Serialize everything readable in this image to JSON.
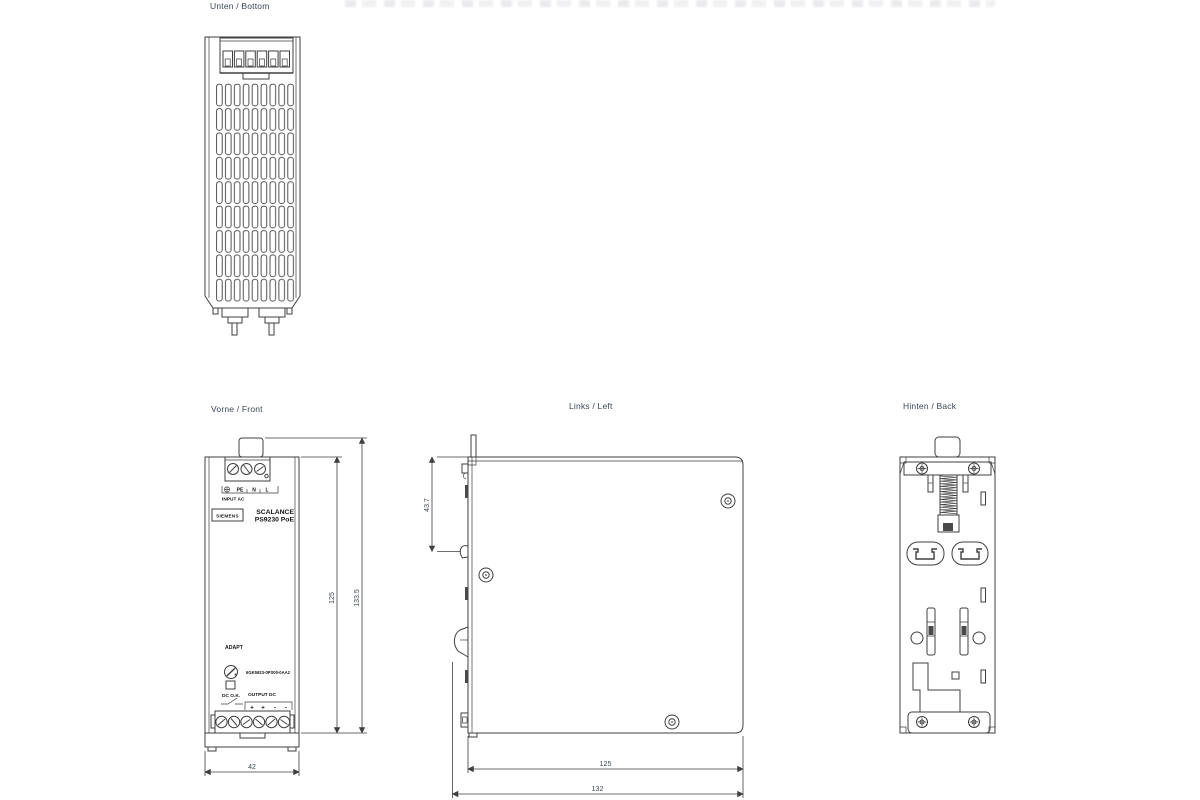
{
  "colors": {
    "line": "#3f3f3f",
    "dim": "#3b4559",
    "device-text": "#141414",
    "bg": "#ffffff"
  },
  "views": {
    "bottom": {
      "label": "Unten / Bottom"
    },
    "front": {
      "label": "Vorne / Front",
      "brand": "SIEMENS",
      "product_line1": "SCALANCE",
      "product_line2": "PS9230 PoE",
      "input_terminals": [
        "PE",
        "N",
        "L"
      ],
      "input_caption": "INPUT AC",
      "adjust_label": "ADAPT",
      "article_number": "6GK5923-0PS00-0AA2",
      "dc_ok_label": "DC O.K.",
      "output_caption": "OUTPUT DC",
      "output_terminals": [
        "+",
        "+",
        "-",
        "-"
      ],
      "dims": {
        "width": "42",
        "body_height": "125",
        "total_height": "133.5"
      }
    },
    "left": {
      "label": "Links / Left",
      "dims": {
        "rail_offset": "43.7",
        "depth": "125",
        "total_depth": "132"
      }
    },
    "back": {
      "label": "Hinten / Back"
    }
  }
}
